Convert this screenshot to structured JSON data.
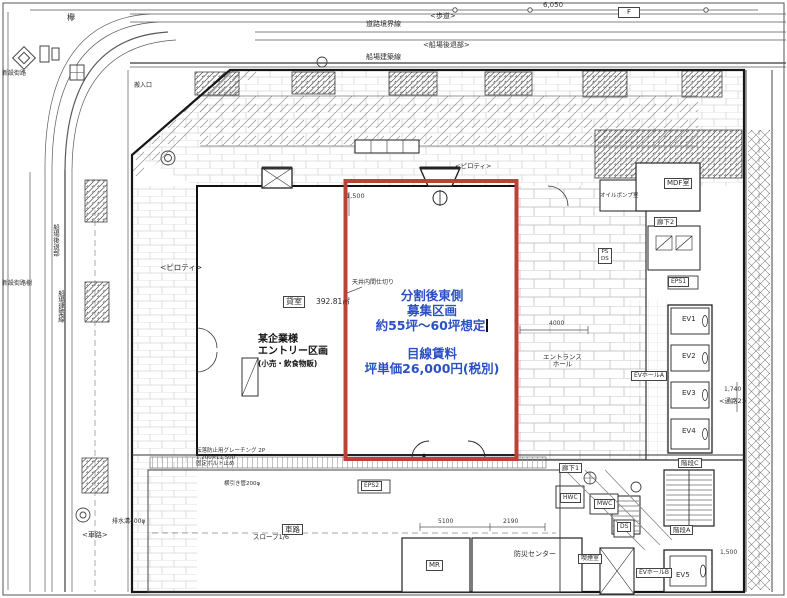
{
  "colors": {
    "boundary_red": "#bd4136",
    "promo_blue": "#2b50c4",
    "ink": "#2c2c2c"
  },
  "promo": {
    "line1": "分割後東側",
    "line2": "募集区画",
    "line3": "約55坪～60坪想定",
    "line4": "目線賃料",
    "line5": "坪単価26,000円(税別)"
  },
  "tenant": {
    "line1": "某企業様",
    "line2": "エントリー区画",
    "line3": "(小売・飲食物販)"
  },
  "rooms": {
    "kashitsu": "貸室",
    "kashitsu_area": "392.81㎡",
    "mdf": "MDF室",
    "oil_pump": "オイルポンプ室",
    "corridor1": "廊下1",
    "corridor2": "廊下2",
    "eps1": "EPS1",
    "eps2": "EPS2",
    "ps_ds": "PS\nDS",
    "ev1": "EV1",
    "ev2": "EV2",
    "ev3": "EV3",
    "ev4": "EV4",
    "ev5": "EV5",
    "ev_hall_a": "EVホールA",
    "ev_hall_b": "EVホールB",
    "stair_a": "階段A",
    "stair_c": "階段C",
    "hwc": "HWC",
    "mwc": "MWC",
    "ds": "DS",
    "smoking": "喫煙室",
    "mr": "MR",
    "bousai": "防災センター",
    "entrance_hall": "エントランス\nホール"
  },
  "site": {
    "keyaki": "欅",
    "road_boundary": "道路境界線",
    "sidewalk": "<歩道>",
    "semba_setback": "<船場後退部>",
    "semba_line": "船場建築線",
    "semba_setback_v": "船場後退部",
    "semba_line_v": "船場建築線",
    "new_street": "新設街路",
    "new_street_tree": "新設街路樹",
    "piloti": "<ピロティ>",
    "piloti2": "<ピロティ>",
    "sharo_left": "<車路>",
    "sharo": "車路",
    "slope": "スロープ1/6",
    "tsuro2": "<通路2>",
    "drain": "排水溝400φ",
    "hanyu": "搬入口",
    "f_mark": "F"
  },
  "notes": {
    "ceiling_partition": "天井内間仕切り",
    "grating": "転落防止用グレーチング 2P\n1,200×L1,500\n固定ボルト止め",
    "yokobiki": "横引き管200φ"
  },
  "dims": {
    "d6050": "6,050",
    "d1500": "1,500",
    "d4000": "4000",
    "d5100": "5100",
    "d2190": "2190",
    "d1740": "1,740",
    "d1500b": "1,500"
  }
}
